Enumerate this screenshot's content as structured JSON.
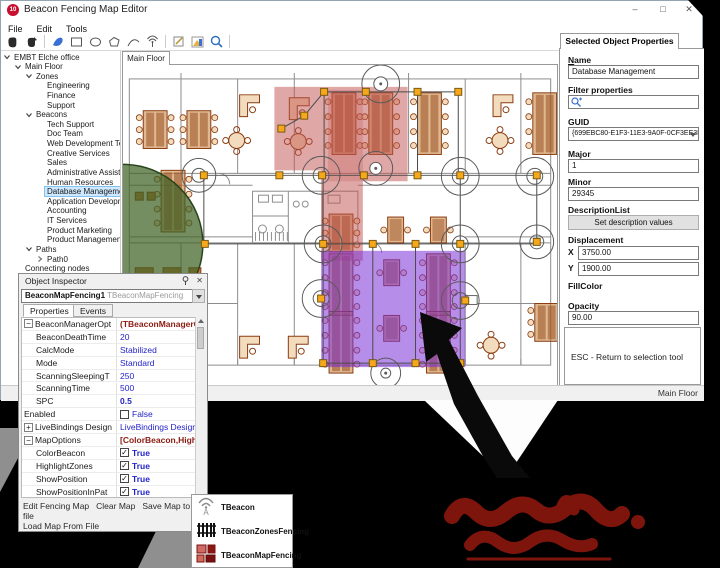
{
  "window": {
    "title": "Beacon Fencing Map Editor",
    "minimize_label": "–",
    "maximize_label": "□",
    "close_label": "✕",
    "status_right": "Main Floor"
  },
  "menu": {
    "items": [
      "File",
      "Edit",
      "Tools"
    ]
  },
  "map": {
    "tab_label": "Main Floor",
    "zone_colors": {
      "red": "#c0504d",
      "purple": "#7b2fd9",
      "green": "#3f6326"
    },
    "handle_color": "#f5a81c"
  },
  "tree": {
    "items": [
      {
        "label": "EMBT Elche office",
        "level": 0,
        "expand": "open"
      },
      {
        "label": "Main Floor",
        "level": 1,
        "expand": "open"
      },
      {
        "label": "Zones",
        "level": 2,
        "expand": "open"
      },
      {
        "label": "Engineering",
        "level": 3
      },
      {
        "label": "Finance",
        "level": 3
      },
      {
        "label": "Support",
        "level": 3
      },
      {
        "label": "Beacons",
        "level": 2,
        "expand": "open"
      },
      {
        "label": "Tech Support",
        "level": 3
      },
      {
        "label": "Doc Team",
        "level": 3
      },
      {
        "label": "Web Development Team",
        "level": 3
      },
      {
        "label": "Creative Services",
        "level": 3
      },
      {
        "label": "Sales",
        "level": 3
      },
      {
        "label": "Administrative Assistant",
        "level": 3
      },
      {
        "label": "Human Resources",
        "level": 3
      },
      {
        "label": "Database Management",
        "level": 3,
        "selected": true
      },
      {
        "label": "Application Development",
        "level": 3
      },
      {
        "label": "Accounting",
        "level": 3
      },
      {
        "label": "IT Services",
        "level": 3
      },
      {
        "label": "Product Marketing",
        "level": 3
      },
      {
        "label": "Product Management",
        "level": 3
      },
      {
        "label": "Paths",
        "level": 2,
        "expand": "open"
      },
      {
        "label": "Path0",
        "level": 3,
        "expand": "closed"
      },
      {
        "label": "Connecting nodes",
        "level": 1
      }
    ]
  },
  "properties_panel": {
    "tab_label": "Selected Object Properties",
    "name_label": "Name",
    "name_value": "Database Management",
    "filter_label": "Filter properties",
    "guid_label": "GUID",
    "guid_value": "{699EBC80-E1F3-11E3-9A0F-0CF3EE3BC(",
    "major_label": "Major",
    "major_value": "1",
    "minor_label": "Minor",
    "minor_value": "29345",
    "description_label": "DescriptionList",
    "description_button": "Set description values",
    "displacement_label": "Displacement",
    "x_label": "X",
    "x_value": "3750.00",
    "y_label": "Y",
    "y_value": "1900.00",
    "fillcolor_label": "FillColor",
    "opacity_label": "Opacity",
    "opacity_value": "90.00",
    "hint_text": "ESC - Return to selection tool"
  },
  "object_inspector": {
    "title": "Object Inspector",
    "instance": "BeaconMapFencing1",
    "instance_type": "TBeaconMapFencing",
    "tabs": [
      "Properties",
      "Events"
    ],
    "rows": [
      {
        "name": "BeaconManagerOpt",
        "value": "(TBeaconManagerOptions)",
        "kind": "category",
        "expand": "minus",
        "indent": 0
      },
      {
        "name": "BeaconDeathTime",
        "value": "20",
        "kind": "value",
        "indent": 1
      },
      {
        "name": "CalcMode",
        "value": "Stabilized",
        "kind": "value",
        "indent": 1
      },
      {
        "name": "Mode",
        "value": "Standard",
        "kind": "value",
        "indent": 1
      },
      {
        "name": "ScanningSleepingT",
        "value": "250",
        "kind": "value",
        "indent": 1
      },
      {
        "name": "ScanningTime",
        "value": "500",
        "kind": "value",
        "indent": 1
      },
      {
        "name": "SPC",
        "value": "0.5",
        "kind": "value-bold",
        "indent": 1
      },
      {
        "name": "Enabled",
        "value": "False",
        "kind": "checkbox-unchecked",
        "indent": 0
      },
      {
        "name": "LiveBindings Design",
        "value": "LiveBindings Designer",
        "kind": "link",
        "expand": "plus",
        "indent": 0
      },
      {
        "name": "MapOptions",
        "value": "[ColorBeacon,HighlightZone",
        "kind": "category",
        "expand": "minus",
        "indent": 0
      },
      {
        "name": "ColorBeacon",
        "value": "True",
        "kind": "checkbox-checked",
        "indent": 1
      },
      {
        "name": "HighlightZones",
        "value": "True",
        "kind": "checkbox-checked",
        "indent": 1
      },
      {
        "name": "ShowPosition",
        "value": "True",
        "kind": "checkbox-checked",
        "indent": 1
      },
      {
        "name": "ShowPositionInPat",
        "value": "True",
        "kind": "checkbox-checked",
        "indent": 1
      }
    ],
    "links": [
      "Edit Fencing Map",
      "Clear Map",
      "Save Map to file",
      "Load Map From File"
    ]
  },
  "palette": {
    "items": [
      {
        "icon": "beacon-signal-icon",
        "label": "TBeacon"
      },
      {
        "icon": "fence-icon",
        "label": "TBeaconZonesFencing"
      },
      {
        "icon": "map-zones-icon",
        "label": "TBeaconMapFencing"
      }
    ]
  }
}
